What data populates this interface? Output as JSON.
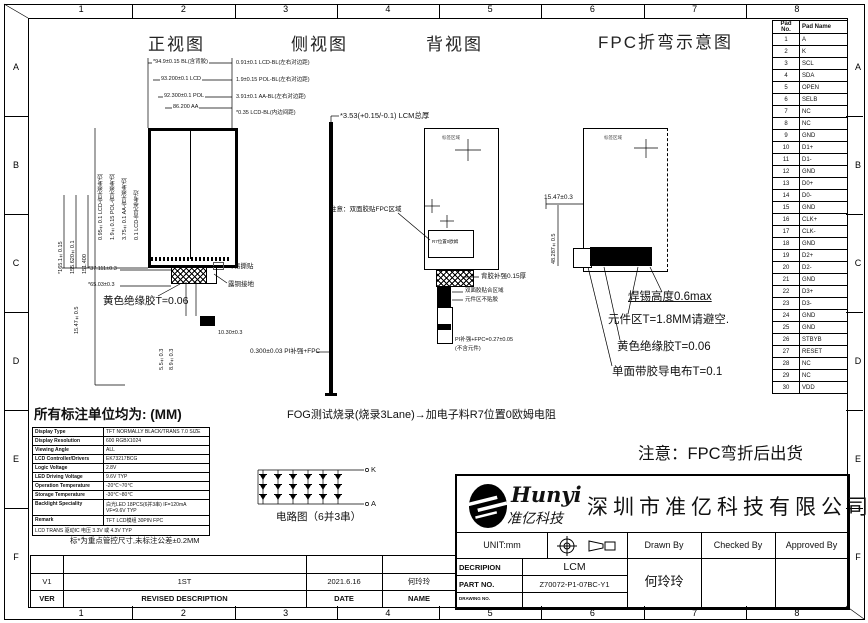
{
  "frame": {
    "top_numbers": [
      "1",
      "2",
      "3",
      "4",
      "5",
      "6",
      "7",
      "8"
    ],
    "bottom_numbers": [
      "1",
      "2",
      "3",
      "4",
      "5",
      "6",
      "7",
      "8"
    ],
    "left_letters": [
      "A",
      "B",
      "C",
      "D",
      "E",
      "F"
    ],
    "right_letters": [
      "A",
      "B",
      "C",
      "D",
      "E",
      "F"
    ]
  },
  "titles": {
    "front": "正视图",
    "side": "侧视图",
    "back": "背视图",
    "fpc": "FPC折弯示意图"
  },
  "front_view": {
    "dims_top": [
      "*94.9±0.15 BL(含背胶)",
      "93.200±0.1 LCD",
      "92.300±0.1 POL",
      "86.200 AA"
    ],
    "dims_right": [
      "0.91±0.1 LCD-BL(左右对边距)",
      "1.9±0.15 POL-BL(左右对边距)",
      "3.91±0.1 AA-BL(左右对边距)",
      "*0.35 LCD-BL(内边间距)"
    ],
    "rot_a": [
      "0.95±0.1 LCD-背光参考边",
      "1.9±0.15 POL-背光参考边",
      "3.75±0.1 AA-背光参考边",
      "0.1 LCD-背光参考边"
    ],
    "rot_b": [
      "*165.1±0.15",
      "155.620±0.1",
      "151.400"
    ],
    "rot_c": "15.47±0.5",
    "tail_dims": [
      "5.5±0.3",
      "8.9±0.3"
    ],
    "tail_width": "10.30±0.3",
    "dim_b1": "*37.111±0.3",
    "dim_b2": "*65.03±0.3",
    "tape": "黄色绝缘胶T=0.06",
    "sticker": "易撕贴",
    "ground": "露铜接地",
    "pi": "0.300±0.03 PI补强+FPC"
  },
  "side_view": {
    "thickness": "*3.53(+0.15/-0.1) LCM总厚"
  },
  "back_view": {
    "label_area": "标签区域",
    "note": "注意：双面胶贴FPC区域",
    "inner_box": "R7位置0欧姆",
    "callout_hatch": "背胶补强0.15厚",
    "callout_tape": "双面胶贴合区域",
    "callout_comp": "元件区不贴胶",
    "dim1": "PI补强+FPC=0.27±0.05",
    "dim2": "(不含元件)"
  },
  "fpc_view": {
    "label_area": "标签区域",
    "dim_top": "15.47±0.3",
    "dim_left": "48.287±0.5",
    "callouts": [
      "焊锡高度0.6max",
      "元件区T=1.8MM请避空.",
      "黄色绝缘胶T=0.06",
      "单面带胶导电布T=0.1"
    ]
  },
  "pin_table": {
    "headers": [
      "Pad No.",
      "Pad Name"
    ],
    "rows": [
      [
        "1",
        "A"
      ],
      [
        "2",
        "K"
      ],
      [
        "3",
        "SCL"
      ],
      [
        "4",
        "SDA"
      ],
      [
        "5",
        "OPEN"
      ],
      [
        "6",
        "SELB"
      ],
      [
        "7",
        "NC"
      ],
      [
        "8",
        "NC"
      ],
      [
        "9",
        "GND"
      ],
      [
        "10",
        "D1+"
      ],
      [
        "11",
        "D1-"
      ],
      [
        "12",
        "GND"
      ],
      [
        "13",
        "D0+"
      ],
      [
        "14",
        "D0-"
      ],
      [
        "15",
        "GND"
      ],
      [
        "16",
        "CLK+"
      ],
      [
        "17",
        "CLK-"
      ],
      [
        "18",
        "GND"
      ],
      [
        "19",
        "D2+"
      ],
      [
        "20",
        "D2-"
      ],
      [
        "21",
        "GND"
      ],
      [
        "22",
        "D3+"
      ],
      [
        "23",
        "D3-"
      ],
      [
        "24",
        "GND"
      ],
      [
        "25",
        "GND"
      ],
      [
        "26",
        "STBYB"
      ],
      [
        "27",
        "RESET"
      ],
      [
        "28",
        "NC"
      ],
      [
        "29",
        "NC"
      ],
      [
        "30",
        "VDD"
      ]
    ]
  },
  "notes": {
    "units": "所有标注单位均为: (MM)",
    "fog": "FOG测试烧录(烧录3Lane)→加电子料R7位置0欧姆电阻",
    "shipping": "注意：FPC弯折后出货",
    "tolerance": "标*为重点管控尺寸,未标注公差±0.2MM"
  },
  "circuit": {
    "caption": "电路图（6并3串）",
    "top_terminal": "K",
    "bottom_terminal": "A"
  },
  "spec_table": {
    "rows": [
      [
        "Display Type",
        "TFT NORMALLY BLACK/TRANS 7.0 SIZE"
      ],
      [
        "Display Resolution",
        "600 RGBX1024"
      ],
      [
        "Viewing Angle",
        "ALL"
      ],
      [
        "LCD Controller/Drivers",
        "EK73217BCG"
      ],
      [
        "Logic Voltage",
        "2.8V"
      ],
      [
        "LED Driving Voltage",
        "9.6V TYP"
      ],
      [
        "Operation Temperature",
        "-20℃~70℃"
      ],
      [
        "Storage Temperature",
        "-30℃~80℃"
      ],
      [
        "Backlight Speciality",
        "白光LED 18PCS(6并3串) IF=120mA VF=9.6V TYP"
      ],
      [
        "Remark",
        "TFT LCD模组 30PIN FPC"
      ]
    ],
    "span_row": "LCD TRANS 驱动IC 电压 3.3V 或 4.3V TYP"
  },
  "revision": {
    "ver": "V1",
    "desc": "1ST",
    "date": "2021.6.16",
    "name": "何玲玲",
    "h_ver": "VER",
    "h_desc": "REVISED DESCRIPTION",
    "h_date": "DATE",
    "h_name": "NAME"
  },
  "title_block": {
    "brand": "Hunyi",
    "brand_cn": "准亿科技",
    "company": "深圳市准亿科技有限公司",
    "unit": "UNIT:mm",
    "desc_label": "DECRIPION",
    "desc_value": "LCM",
    "part_label": "PART NO.",
    "part_value": "Z70072-P1-07BC-Y1",
    "drawing_label": "DRAWING NO.",
    "drawing_value": "",
    "drawn": "Drawn By",
    "checked": "Checked By",
    "approved": "Approved By",
    "drawn_name": "何玲玲"
  }
}
